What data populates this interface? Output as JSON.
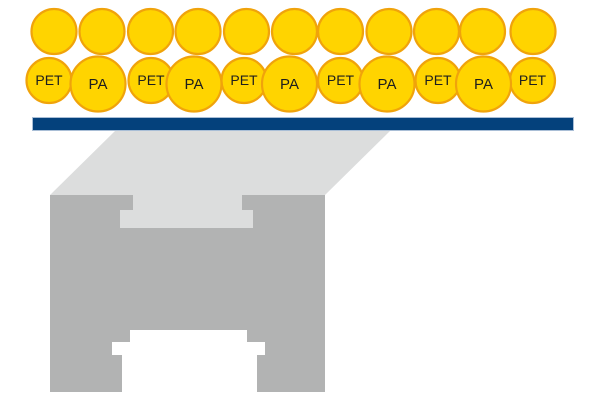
{
  "diagram": {
    "background": "#FFFFFF",
    "particles": {
      "fill": "#FFD400",
      "stroke": "#F0A30B",
      "stroke_width": 2.2,
      "label_color": "#1E1E1E",
      "top_row": {
        "label": "",
        "r": 22.5,
        "cy": 31.5,
        "cx": [
          54,
          102,
          150.5,
          198,
          246.5,
          294.5,
          340.5,
          389,
          436.5,
          482.5,
          533
        ]
      },
      "pet_row": {
        "label": "PET",
        "r": 22.5,
        "cy": 80.5,
        "cx": [
          49,
          151,
          244,
          340.5,
          438,
          532.5
        ]
      },
      "pa_row": {
        "label": "PA",
        "r": 27.5,
        "cy": 84,
        "cx": [
          98,
          194,
          289.5,
          387,
          483.5
        ]
      }
    },
    "substrate_bar": {
      "x": 32.5,
      "y": 117.5,
      "width": 541,
      "height": 13,
      "fill": "#04417C",
      "stroke": "#A9BED6",
      "stroke_width": 1
    },
    "stage": {
      "top_face": {
        "points": "115,131 390,131 325,195 50,195",
        "fill": "#DCDDDD"
      },
      "front_face": {
        "x": 50,
        "y": 195,
        "width": 275,
        "height": 197,
        "fill": "#B2B3B3"
      },
      "top_notch": {
        "points": "133,195 242,195 242,210 253,210 253,228 120,228 120,210 133,210",
        "fill": "#DCDDDD"
      },
      "bottom_cutout": {
        "points": "130,330 247,330 247,342 265,342 265,355 257,355 257,392 122,392 122,355 112,355 112,342 130,342",
        "fill": "#FFFFFF"
      }
    }
  }
}
